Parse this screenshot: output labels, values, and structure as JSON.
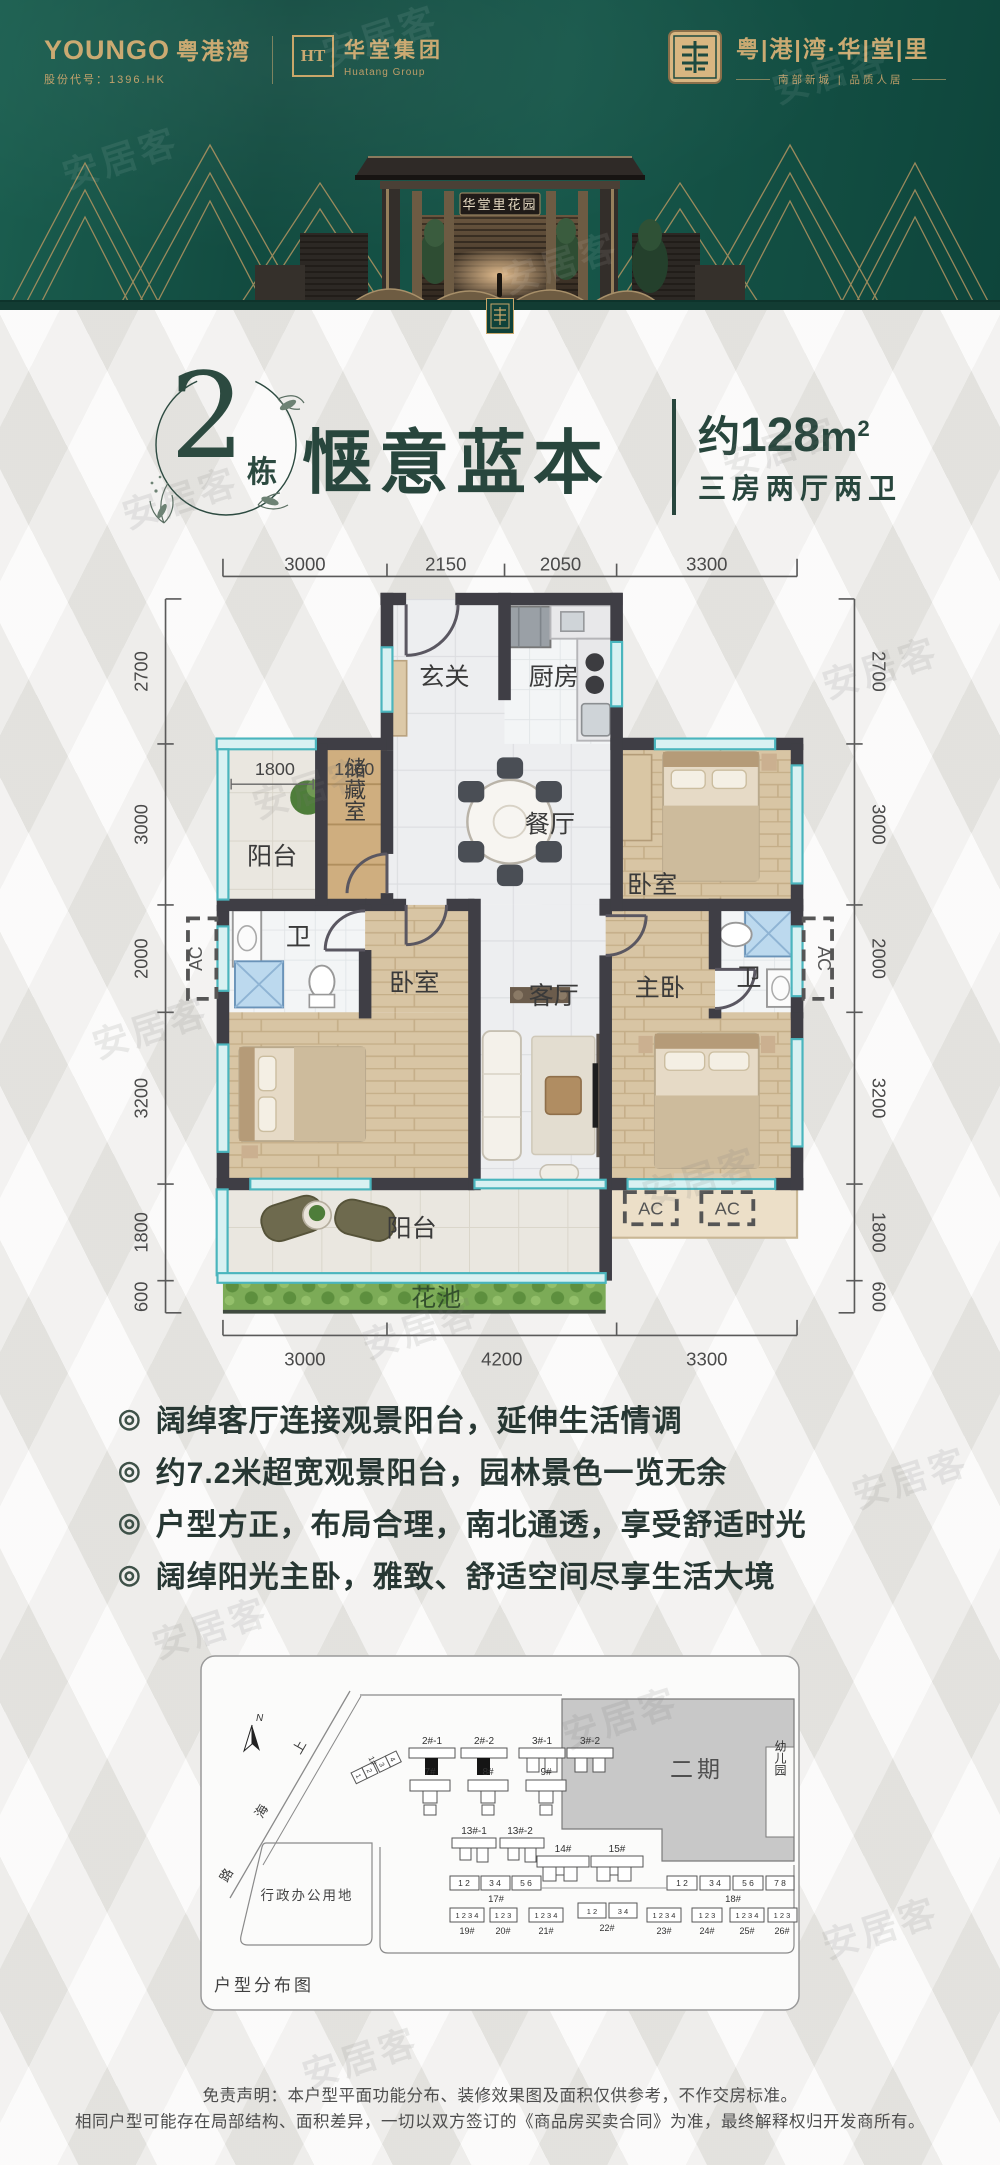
{
  "watermark": "安居客",
  "header": {
    "brand_left": {
      "name_en": "YOUNGO",
      "name_cn": "粤港湾",
      "stock": "股份代号：1396.HK"
    },
    "brand_mid": {
      "monogram": "HT",
      "name": "华堂集团",
      "name_en": "Huatang Group"
    },
    "brand_right": {
      "project": "粤|港|湾·华|堂|里",
      "subtitle": "南部新城 | 品质人居"
    },
    "gate_sign": "华堂里花园"
  },
  "title": {
    "block_num": "2",
    "block_suffix": "栋",
    "headline": "惬意蓝本",
    "area_prefix": "约",
    "area_value": "128",
    "area_unit": "m",
    "area_sup": "2",
    "spec": "三房两厅两卫"
  },
  "floor_plan": {
    "dims_top": [
      "3000",
      "2150",
      "2050",
      "3300"
    ],
    "dims_bottom": [
      "3000",
      "4200",
      "3300"
    ],
    "dims_left": [
      "2700",
      "3000",
      "2000",
      "3200",
      "1800",
      "600"
    ],
    "dims_right": [
      "2700",
      "3000",
      "2000",
      "3200",
      "1800",
      "600"
    ],
    "rooms": {
      "entry": "玄关",
      "kitchen": "厨房",
      "dining": "餐厅",
      "storage": "储藏室",
      "balcony_small": "阳台",
      "bedroom1": "卧室",
      "bath1": "卫",
      "bedroom2": "卧室",
      "living": "客厅",
      "master": "主卧",
      "bath2": "卫",
      "balcony_big": "阳台",
      "flower_bed": "花池"
    },
    "labels": {
      "w1800": "1800",
      "w1200": "1200",
      "ac": "AC"
    }
  },
  "features": [
    "阔绰客厅连接观景阳台，延伸生活情调",
    "约7.2米超宽观景阳台，园林景色一览无余",
    "户型方正，布局合理，南北通透，享受舒适时光",
    "阔绰阳光主卧，雅致、舒适空间尽享生活大境"
  ],
  "site_plan": {
    "caption": "户型分布图",
    "north_label": "N",
    "road_chars": [
      "上",
      "海",
      "路"
    ],
    "phase2_label": "二期",
    "kindergarten_label": "幼儿园",
    "admin_label": "行政办公用地",
    "tower_1": {
      "id": "1#",
      "units": [
        "1",
        "2",
        "3",
        "4"
      ]
    },
    "towers_row1": [
      {
        "id": "2#-1"
      },
      {
        "id": "2#-2"
      },
      {
        "id": "3#-1"
      },
      {
        "id": "3#-2"
      }
    ],
    "towers_row2": [
      {
        "id": "7#"
      },
      {
        "id": "8#"
      },
      {
        "id": "9#"
      }
    ],
    "towers_row3": [
      {
        "id": "13#-1"
      },
      {
        "id": "13#-2"
      }
    ],
    "towers_row4": [
      {
        "id": "14#"
      },
      {
        "id": "15#"
      }
    ],
    "strips": [
      {
        "id": "17#",
        "groups": [
          "1 2",
          "3 4",
          "5 6"
        ]
      },
      {
        "id": "18#",
        "groups": [
          "1 2",
          "3 4",
          "5 6",
          "7 8"
        ]
      },
      {
        "id": "19#",
        "groups": [
          "1 2 3 4"
        ]
      },
      {
        "id": "20#",
        "groups": [
          "1 2 3"
        ]
      },
      {
        "id": "21#",
        "groups": [
          "1 2 3 4"
        ]
      },
      {
        "id": "22#",
        "groups": [
          "1 2",
          "3 4"
        ]
      },
      {
        "id": "23#",
        "groups": [
          "1 2 3 4"
        ]
      },
      {
        "id": "24#",
        "groups": [
          "1 2 3"
        ]
      },
      {
        "id": "25#",
        "groups": [
          "1 2 3 4"
        ]
      },
      {
        "id": "26#",
        "groups": [
          "1 2 3"
        ]
      }
    ]
  },
  "disclaimer": [
    "免责声明：本户型平面功能分布、装修效果图及面积仅供参考，不作交房标准。",
    "相同户型可能存在局部结构、面积差异，一切以双方签订的《商品房买卖合同》为准，最终解释权归开发商所有。"
  ]
}
